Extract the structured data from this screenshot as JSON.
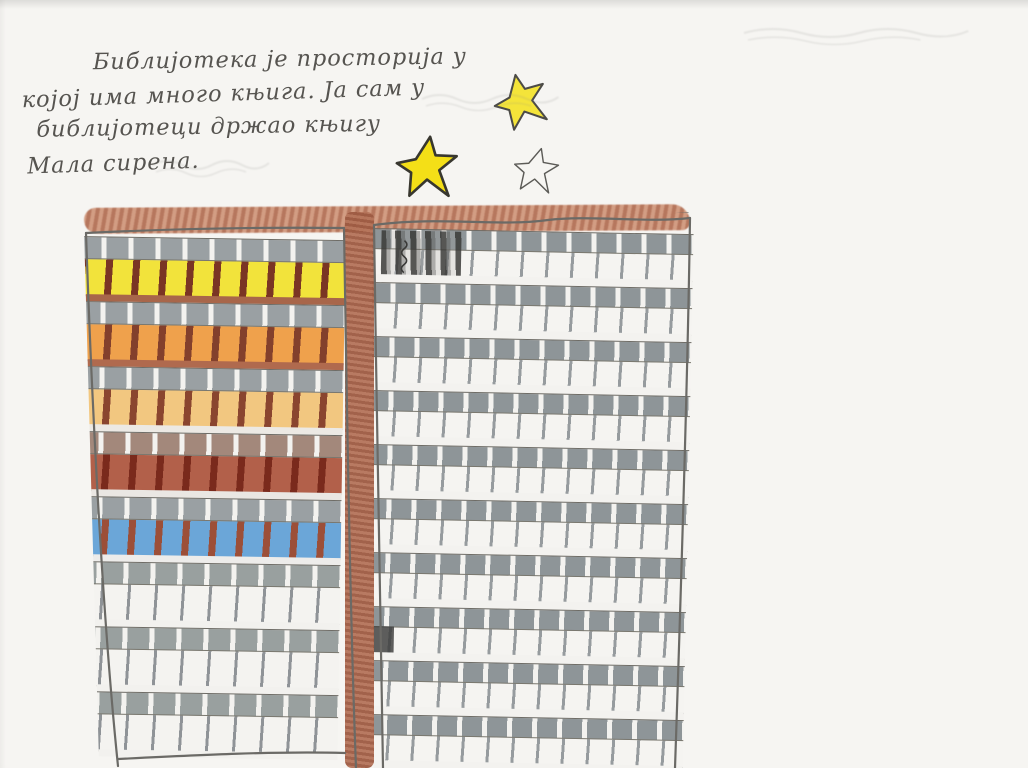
{
  "page": {
    "paper_color": "#f6f5f2",
    "pencil_color": "#6b6a66"
  },
  "handwriting": {
    "color": "#565450",
    "lines": [
      {
        "indent": 72,
        "text": "Библијотека је просторија у"
      },
      {
        "indent": 0,
        "text": "којој има много књига. Ја сам у"
      },
      {
        "indent": 14,
        "text": "библијотеци држао књигу"
      },
      {
        "indent": 4,
        "text": "Мала сирена."
      }
    ]
  },
  "stars": [
    {
      "id": "star-top",
      "x": 492,
      "y": 72,
      "size": 58,
      "filled": true,
      "fill": "#f4e43a",
      "outline": "#4c4b47",
      "stroke_width": 3.5,
      "rotation": -12
    },
    {
      "id": "star-left",
      "x": 394,
      "y": 134,
      "size": 66,
      "filled": true,
      "fill": "#f4df17",
      "outline": "#38372f",
      "stroke_width": 4,
      "rotation": 6
    },
    {
      "id": "star-right",
      "x": 512,
      "y": 146,
      "size": 48,
      "filled": false,
      "fill": "none",
      "outline": "#5c5b57",
      "stroke_width": 3,
      "rotation": 14
    }
  ],
  "ghost_marks": [
    {
      "id": "ghost-text-near-stars",
      "x": 420,
      "y": 84,
      "w": 140,
      "h": 30,
      "note": "faint erased pencil writing"
    },
    {
      "id": "ghost-signature-top-right",
      "x": 742,
      "y": 16,
      "w": 230,
      "h": 34,
      "note": "very faint pencil signature"
    },
    {
      "id": "ghost-smudge-text",
      "x": 150,
      "y": 148,
      "w": 120,
      "h": 34,
      "note": "faint pencil smudge under text"
    }
  ],
  "building": {
    "x": 78,
    "y": 212,
    "w": 616,
    "h": 556,
    "roof": {
      "x": 6,
      "y": -6,
      "w": 606,
      "h": 26,
      "color": "#b06a4e",
      "light": "#cf9478"
    },
    "divider": {
      "x": 267,
      "w": 29,
      "color_a": "#b5745a",
      "color_b": "#9d5a42"
    },
    "left_section": {
      "x": 2,
      "w": 266,
      "rotate_deg": 0.9,
      "metrics": {
        "start": 24,
        "spandrel_h": 22,
        "window_h": 36,
        "slab_h": 7,
        "pitch": 27
      },
      "windows_per_floor": 10,
      "floors": [
        {
          "name": "yellow-floor",
          "window": "#f2e33b",
          "mullion": "#7a3524",
          "mw": 7,
          "spandrel": "#9aa0a3",
          "slab": "#a8664a"
        },
        {
          "name": "orange-floor",
          "window": "#efa14c",
          "mullion": "#83402c",
          "mw": 7,
          "spandrel": "#9aa0a3",
          "slab": "#b06a4e"
        },
        {
          "name": "amber-floor",
          "window": "#f2c780",
          "mullion": "#8a452f",
          "mw": 7,
          "spandrel": "#9aa0a3",
          "slab": "#ece9e4"
        },
        {
          "name": "brick-floor",
          "window": "#b2604a",
          "mullion": "#7a2a1c",
          "mw": 7,
          "spandrel": "#a3887b",
          "slab": "#eae7e3"
        },
        {
          "name": "blue-floor",
          "window": "#6ba6d8",
          "mullion": "#9c4f38",
          "mw": 7,
          "spandrel": "#9aa0a3",
          "slab": "#edecea"
        },
        {
          "name": "pencil-floor",
          "window": "#f4f3f0",
          "mullion": "#8f9397",
          "mw": 3,
          "spandrel": "#99a09f",
          "slab": "#f2f1ee"
        },
        {
          "name": "pencil-floor",
          "window": "#f4f3f0",
          "mullion": "#8f9397",
          "mw": 3,
          "spandrel": "#99a09f",
          "slab": "#f2f1ee"
        },
        {
          "name": "pencil-floor",
          "window": "#f4f3f0",
          "mullion": "#8f9397",
          "mw": 3,
          "spandrel": "#99a09f",
          "slab": "#f2f1ee"
        }
      ]
    },
    "right_section": {
      "x": 294,
      "w": 322,
      "rotate_deg": 1.1,
      "floor_count": 10,
      "metrics": {
        "start": 16,
        "spandrel_h": 20,
        "window_h": 26,
        "slab_h": 8,
        "pitch": 25
      },
      "windows_per_floor": 13,
      "palette": {
        "window": "#f5f4f1",
        "mullion": "#969b9e",
        "mw": 3,
        "spandrel": "#8e9598",
        "slab": "#f3f2ef"
      },
      "details": {
        "scribble": {
          "x": 10,
          "y": 18,
          "w": 80,
          "h": 44,
          "color": "#3a3a38"
        },
        "squiggle": {
          "x": 26,
          "y": 26,
          "h": 36,
          "color": "#3a3a38"
        },
        "dark_window": {
          "x": 0,
          "y": 414,
          "w": 30,
          "h": 26,
          "color": "#3c3c3a"
        }
      }
    }
  }
}
